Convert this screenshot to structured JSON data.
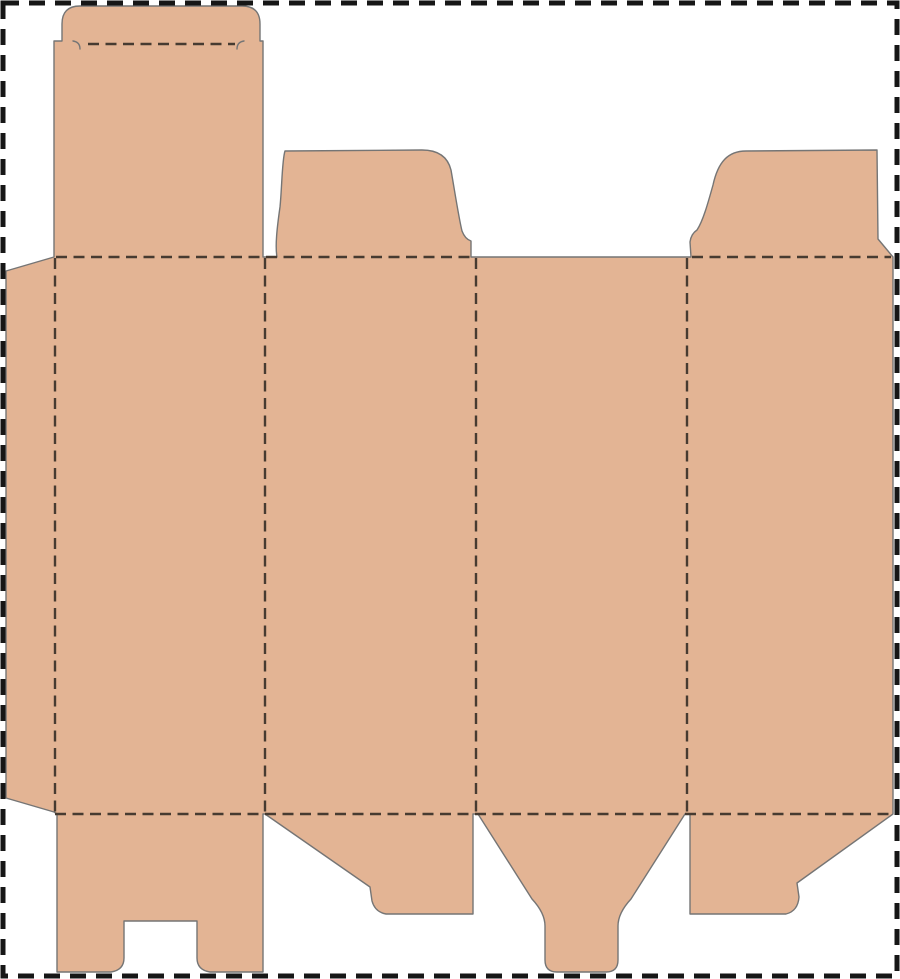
{
  "page": {
    "kind": "packaging-dieline-template",
    "background": "#ffffff",
    "width": 900,
    "height": 979
  },
  "palette": {
    "cardboard_fill": "#E3B494",
    "cut_stroke": "#757575",
    "fold_stroke": "#473B31",
    "border_stroke": "#161616"
  },
  "border": {
    "x": 3,
    "y": 3,
    "width": 894,
    "height": 973,
    "stroke_width": 5,
    "dash": "16 10"
  },
  "dieline": {
    "cut_stroke_width": 1.4,
    "fold_stroke_width": 2.4,
    "fold_dash": "11 6.5",
    "parts": [
      {
        "name": "sheet-silhouette",
        "type": "cut-filled",
        "path": "M 6,271 L 54,257 L 54,41 L 62,41 L 62,24 Q 62,6 80,6 L 242,6 Q 260,6 260,24 L 260,41 L 263,41 L 263,257 L 277,257 C 275,246 277,228 280,207 C 282,187 282,160 285,151 L 422,150 Q 446,150 451,170 C 455,193 459,219 462,231 Q 465,239 471,241 L 471,257 L 691,257 L 690,242 Q 691,234 697,230 C 703,221 708,203 713,185 C 718,162 728,151 746,151 L 877,150 L 878,239 L 893,257 L 893,814 L 797,883 L 799,897 Q 798,911 786,914 L 690,914 L 690,814 L 685,814 L 631,899 Q 618,913 618,926 L 618,960 Q 618,972 606,972 L 557,972 Q 545,972 545,960 L 545,926 Q 545,913 532,899 L 478,814 L 473,814 L 473,914 L 386,914 Q 375,912 372,901 L 370,887 L 265,814 L 263,814 L 263,972 L 210,972 Q 197,970 197,958 L 197,921 L 124,921 L 124,958 Q 124,970 111,972 L 57,972 L 57,814 L 54,812 L 6,798 Z"
      },
      {
        "name": "lid-hook-cut-left",
        "type": "cut-line",
        "path": "M 73,41 Q 80,42 80,49"
      },
      {
        "name": "lid-hook-cut-right",
        "type": "cut-line",
        "path": "M 244,41 Q 237,42 237,49"
      }
    ],
    "fold_lines": [
      {
        "name": "lid-tuck-fold",
        "x1": 88,
        "y1": 44,
        "x2": 235,
        "y2": 44
      },
      {
        "name": "top-fold-left",
        "x1": 56,
        "y1": 257,
        "x2": 470,
        "y2": 257
      },
      {
        "name": "top-fold-right",
        "x1": 692,
        "y1": 257,
        "x2": 891,
        "y2": 257
      },
      {
        "name": "bottom-fold",
        "x1": 55,
        "y1": 814,
        "x2": 892,
        "y2": 814
      },
      {
        "name": "glue-flap-fold",
        "x1": 55,
        "y1": 258,
        "x2": 55,
        "y2": 813
      },
      {
        "name": "panel-1-2-fold",
        "x1": 265,
        "y1": 258,
        "x2": 265,
        "y2": 813
      },
      {
        "name": "panel-2-3-fold",
        "x1": 476,
        "y1": 258,
        "x2": 476,
        "y2": 813
      },
      {
        "name": "panel-3-4-fold",
        "x1": 687,
        "y1": 258,
        "x2": 687,
        "y2": 813
      }
    ]
  }
}
